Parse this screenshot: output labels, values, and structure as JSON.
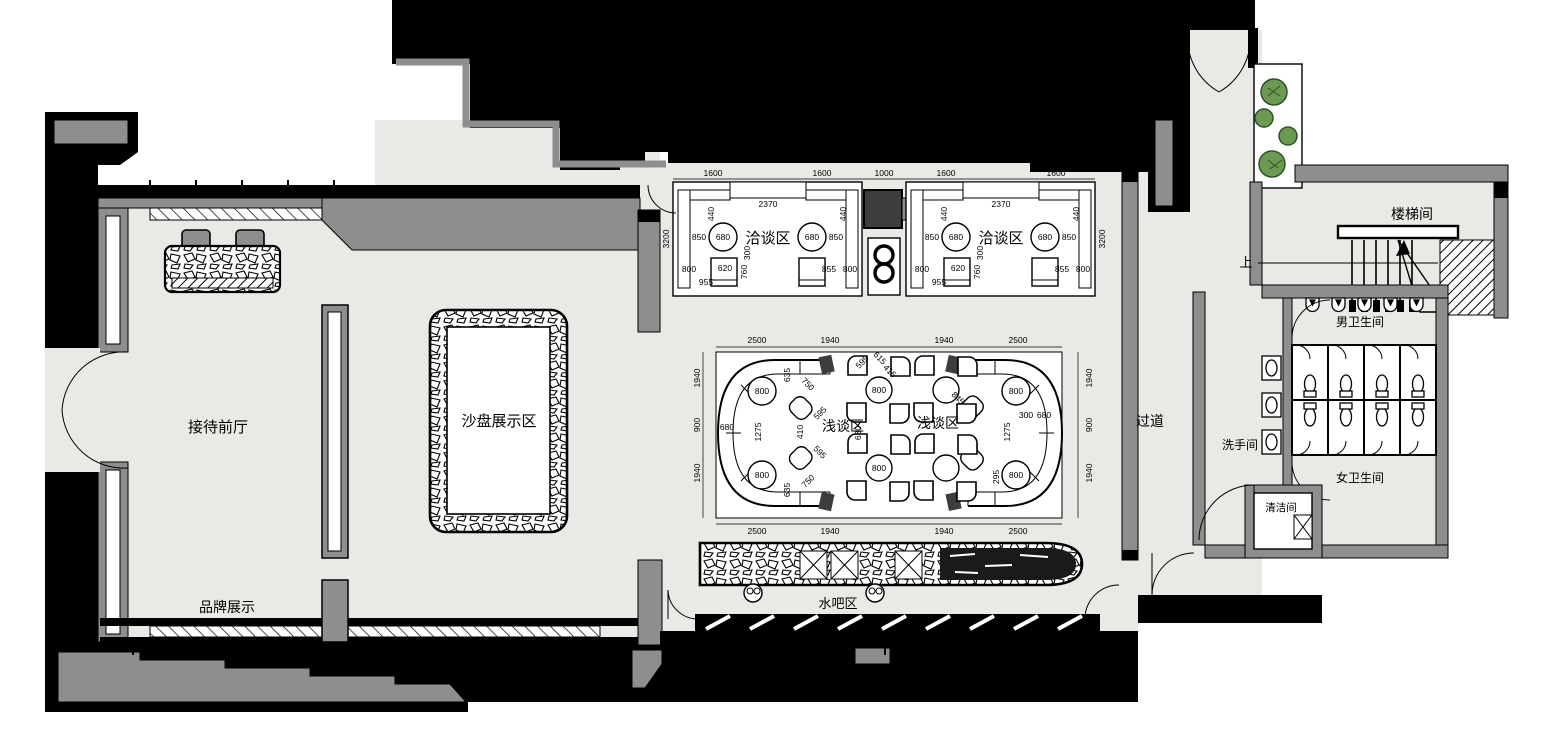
{
  "rooms": {
    "reception": "接待前厅",
    "brand": "品牌展示",
    "sand_table": "沙盘展示区",
    "meeting": "洽谈区",
    "lounge": "浅谈区",
    "water_bar": "水吧区",
    "corridor": "过道",
    "washroom": "洗手间",
    "mens_wc": "男卫生间",
    "womens_wc": "女卫生间",
    "cleaning": "清洁间",
    "stairwell": "楼梯间",
    "up": "上"
  },
  "dims": {
    "d1600": "1600",
    "d1000": "1000",
    "d2370": "2370",
    "d3200": "3200",
    "d440": "440",
    "d850": "850",
    "d680": "680",
    "d800": "800",
    "d620": "620",
    "d955": "955",
    "d855": "855",
    "d760": "760",
    "d300": "300",
    "d2500": "2500",
    "d1940": "1940",
    "d900": "900",
    "d1275": "1275",
    "d635": "635",
    "d750": "750",
    "d410": "410",
    "d595": "595",
    "d615": "615",
    "d630": "630",
    "d845": "845",
    "d295": "295",
    "d415": "415"
  },
  "colors": {
    "floor": "#e9e9e6",
    "wall_fill": "#8e8e8e",
    "poche": "#000000",
    "plant_green": "#6d9a52",
    "plant_dark": "#31512a"
  }
}
